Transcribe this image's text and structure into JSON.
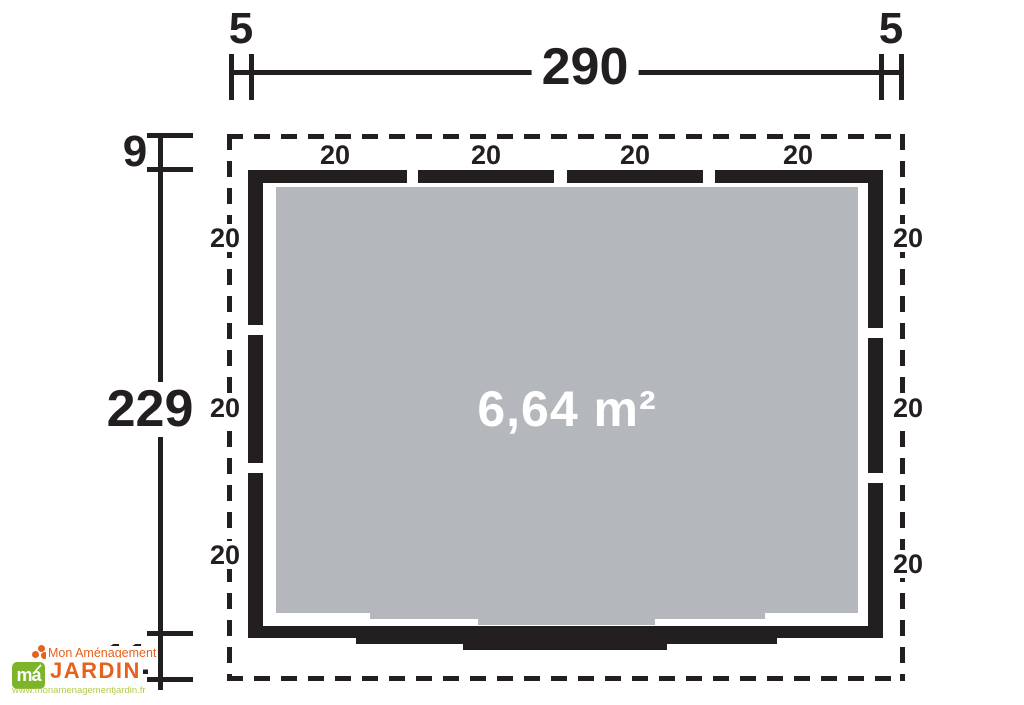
{
  "plan": {
    "area_label": "6,64 m²",
    "dimensions": {
      "top_left_offset": "5",
      "top_width": "290",
      "top_right_offset": "5",
      "left_top_offset": "9",
      "left_height": "229",
      "left_bottom_offset": "11"
    },
    "wall_segment_labels": {
      "top": [
        "20",
        "20",
        "20",
        "20"
      ],
      "left": [
        "20",
        "20",
        "20"
      ],
      "right": [
        "20",
        "20",
        "20"
      ]
    },
    "colors": {
      "line_black": "#231f20",
      "floor_gray": "#b4b7bb"
    }
  },
  "logo": {
    "brand_top": "Mon Aménagement",
    "brand_main": "JARDIN",
    "website": "www.monamenagementjardin.fr",
    "mark_text": "ma",
    "colors": {
      "orange": "#e8611c",
      "green": "#7db52a",
      "light_green": "#b5c94d"
    }
  }
}
